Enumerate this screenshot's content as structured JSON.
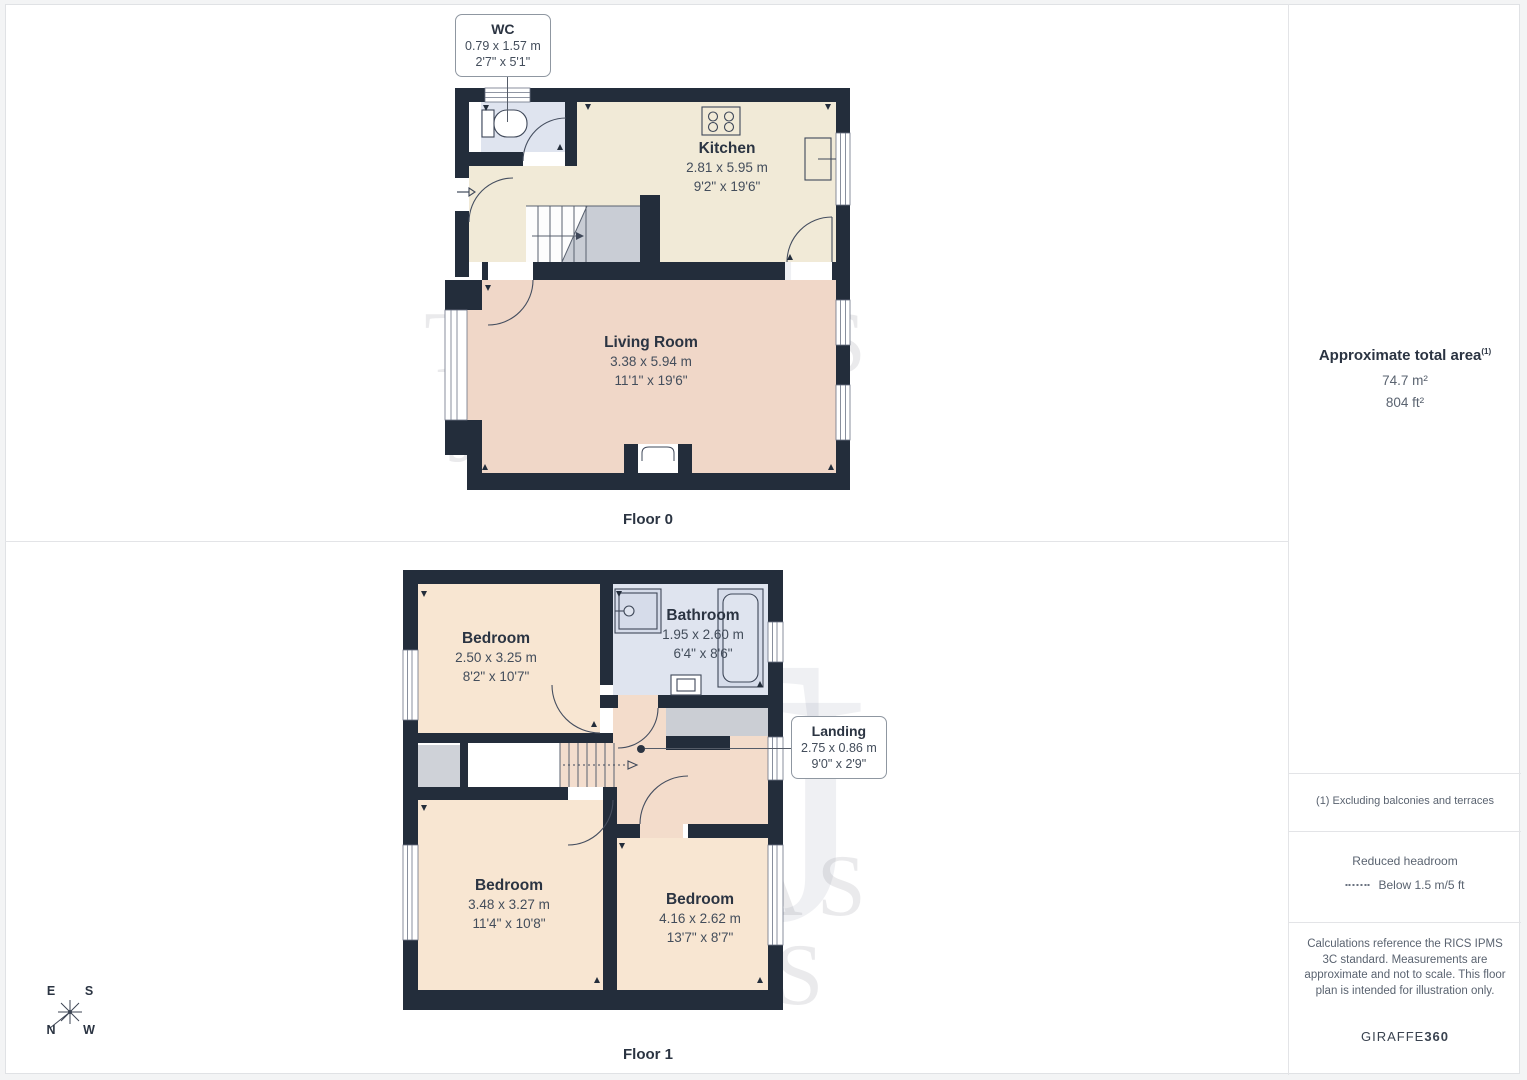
{
  "floors": {
    "floor0": {
      "label": "Floor 0",
      "rooms": {
        "wc": {
          "name": "WC",
          "metric": "0.79 x 1.57 m",
          "imperial": "2'7\" x 5'1\""
        },
        "kitchen": {
          "name": "Kitchen",
          "metric": "2.81 x 5.95 m",
          "imperial": "9'2\" x 19'6\""
        },
        "living_room": {
          "name": "Living Room",
          "metric": "3.38 x 5.94 m",
          "imperial": "11'1\" x 19'6\""
        }
      }
    },
    "floor1": {
      "label": "Floor 1",
      "rooms": {
        "bedroom_1": {
          "name": "Bedroom",
          "metric": "2.50 x 3.25 m",
          "imperial": "8'2\" x 10'7\""
        },
        "bathroom": {
          "name": "Bathroom",
          "metric": "1.95 x 2.60 m",
          "imperial": "6'4\" x 8'6\""
        },
        "landing": {
          "name": "Landing",
          "metric": "2.75 x 0.86 m",
          "imperial": "9'0\" x 2'9\""
        },
        "bedroom_2": {
          "name": "Bedroom",
          "metric": "3.48 x 3.27 m",
          "imperial": "11'4\" x 10'8\""
        },
        "bedroom_3": {
          "name": "Bedroom",
          "metric": "4.16 x 2.62 m",
          "imperial": "13'7\" x 8'7\""
        }
      }
    }
  },
  "sidebar": {
    "area_title": "Approximate total area",
    "area_footnote_marker": "(1)",
    "area_metric": "74.7 m²",
    "area_imperial": "804 ft²",
    "footnote": "(1) Excluding balconies and terraces",
    "headroom_title": "Reduced headroom",
    "headroom_note": "Below 1.5 m/5 ft",
    "disclaimer": "Calculations reference the RICS IPMS 3C standard. Measurements are approximate and not to scale. This floor plan is intended for illustration only.",
    "brand_name": "GIRAFFE",
    "brand_suffix": "360"
  },
  "compass": {
    "north": "N",
    "east": "E",
    "south": "S",
    "west": "W"
  },
  "watermark": {
    "line1": "THOMAS",
    "line2": "JAMES",
    "monogram_t": "T",
    "monogram_j": "J"
  },
  "colors": {
    "wall": "#232d3b",
    "kitchen_floor": "#f1ead7",
    "living_floor": "#f0d7c8",
    "bedroom_floor": "#f8e6d2",
    "landing_floor": "#f3dccb",
    "bathroom_floor": "#dfe4ef",
    "stair_gray": "#c9cdd5",
    "divider_gray": "#e3e4e7"
  }
}
